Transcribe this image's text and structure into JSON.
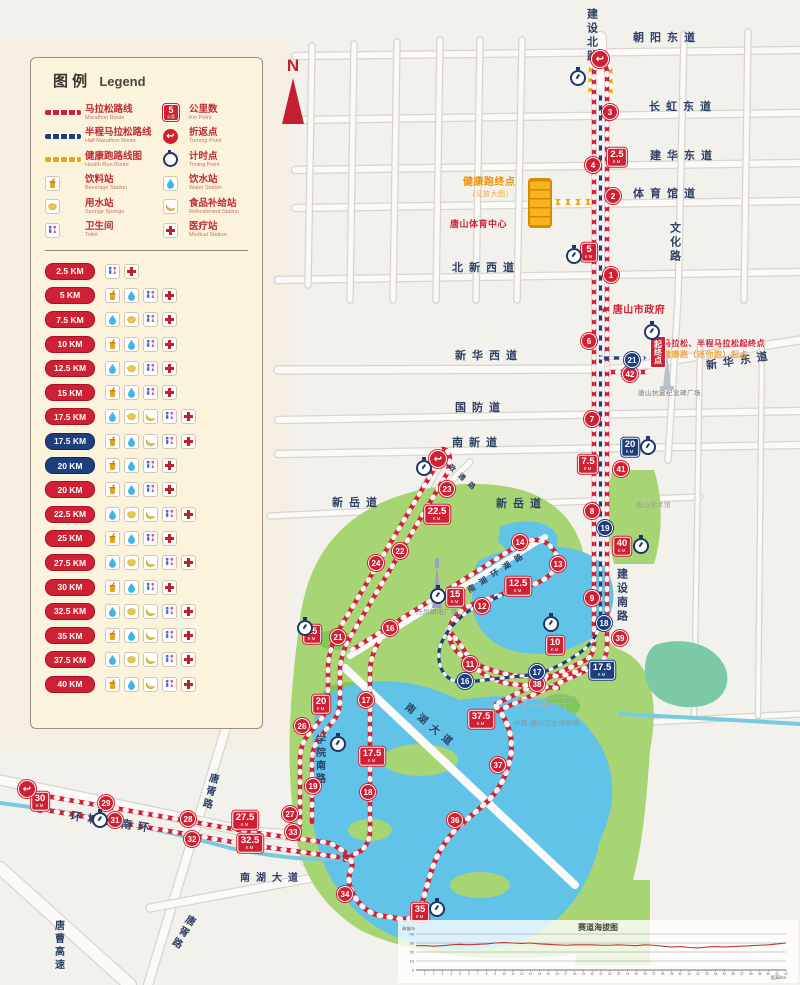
{
  "colors": {
    "marathon_red": "#cf2133",
    "half_blue": "#1d3f7e",
    "health_orange": "#f2a50c",
    "road_label": "#2e3f63"
  },
  "legend": {
    "title_zh": "图 例",
    "title_en": "Legend",
    "badge_sample": {
      "n": "5",
      "u": "公里"
    },
    "col1": [
      {
        "type": "line-red",
        "zh": "马拉松路线",
        "en": "Marathon Route"
      },
      {
        "type": "line-blue",
        "zh": "半程马拉松路线",
        "en": "Half Marathon Route"
      },
      {
        "type": "line-orange",
        "zh": "健康跑路线图",
        "en": "Health Run Route"
      },
      {
        "type": "beverage",
        "zh": "饮料站",
        "en": "Beverage Station"
      },
      {
        "type": "sponge",
        "zh": "用水站",
        "en": "Sponge Sponge"
      },
      {
        "type": "toilet",
        "zh": "卫生间",
        "en": "Toilet"
      }
    ],
    "col2": [
      {
        "type": "kmbadge",
        "zh": "公里数",
        "en": "Km Point"
      },
      {
        "type": "turn",
        "zh": "折返点",
        "en": "Turning Point"
      },
      {
        "type": "timer",
        "zh": "计时点",
        "en": "Timing Point"
      },
      {
        "type": "water",
        "zh": "饮水站",
        "en": "Water Station"
      },
      {
        "type": "food",
        "zh": "食品补给站",
        "en": "Refreshment Station"
      },
      {
        "type": "medical",
        "zh": "医疗站",
        "en": "Medical Station"
      }
    ],
    "km_rows": [
      {
        "km": "2.5 KM",
        "c": "red",
        "icons": [
          "toilet",
          "medical"
        ]
      },
      {
        "km": "5 KM",
        "c": "red",
        "icons": [
          "beverage",
          "water",
          "toilet",
          "medical"
        ]
      },
      {
        "km": "7.5 KM",
        "c": "red",
        "icons": [
          "water",
          "sponge",
          "toilet",
          "medical"
        ]
      },
      {
        "km": "10 KM",
        "c": "red",
        "icons": [
          "beverage",
          "water",
          "toilet",
          "medical"
        ]
      },
      {
        "km": "12.5 KM",
        "c": "red",
        "icons": [
          "water",
          "sponge",
          "toilet",
          "medical"
        ]
      },
      {
        "km": "15 KM",
        "c": "red",
        "icons": [
          "beverage",
          "water",
          "toilet",
          "medical"
        ]
      },
      {
        "km": "17.5 KM",
        "c": "red",
        "icons": [
          "water",
          "sponge",
          "food",
          "toilet",
          "medical"
        ]
      },
      {
        "km": "17.5 KM",
        "c": "blue",
        "icons": [
          "beverage",
          "water",
          "food",
          "toilet",
          "medical"
        ]
      },
      {
        "km": "20 KM",
        "c": "blue",
        "icons": [
          "beverage",
          "water",
          "toilet",
          "medical"
        ]
      },
      {
        "km": "20 KM",
        "c": "red",
        "icons": [
          "beverage",
          "water",
          "toilet",
          "medical"
        ]
      },
      {
        "km": "22.5 KM",
        "c": "red",
        "icons": [
          "water",
          "sponge",
          "food",
          "toilet",
          "medical"
        ]
      },
      {
        "km": "25 KM",
        "c": "red",
        "icons": [
          "beverage",
          "water",
          "toilet",
          "medical"
        ]
      },
      {
        "km": "27.5 KM",
        "c": "red",
        "icons": [
          "water",
          "sponge",
          "food",
          "toilet",
          "medical"
        ]
      },
      {
        "km": "30 KM",
        "c": "red",
        "icons": [
          "beverage",
          "water",
          "toilet",
          "medical"
        ]
      },
      {
        "km": "32.5 KM",
        "c": "red",
        "icons": [
          "water",
          "sponge",
          "food",
          "toilet",
          "medical"
        ]
      },
      {
        "km": "35 KM",
        "c": "red",
        "icons": [
          "beverage",
          "water",
          "food",
          "toilet",
          "medical"
        ]
      },
      {
        "km": "37.5 KM",
        "c": "red",
        "icons": [
          "water",
          "sponge",
          "food",
          "toilet",
          "medical"
        ]
      },
      {
        "km": "40 KM",
        "c": "red",
        "icons": [
          "beverage",
          "water",
          "food",
          "toilet",
          "medical"
        ]
      }
    ]
  },
  "map": {
    "north": "N",
    "unit": "KM",
    "roads": [
      {
        "t": "建设北路",
        "x": 585,
        "y": 8,
        "mode": "v",
        "size": 11
      },
      {
        "t": "朝阳东道",
        "x": 633,
        "y": 33,
        "mode": "h",
        "size": 11
      },
      {
        "t": "长虹东道",
        "x": 649,
        "y": 102,
        "mode": "h",
        "size": 11
      },
      {
        "t": "建华东道",
        "x": 650,
        "y": 151,
        "mode": "h",
        "size": 11
      },
      {
        "t": "体育馆道",
        "x": 633,
        "y": 189,
        "mode": "h",
        "size": 11
      },
      {
        "t": "文化路",
        "x": 668,
        "y": 222,
        "mode": "v",
        "size": 11
      },
      {
        "t": "北新西道",
        "x": 452,
        "y": 263,
        "mode": "h",
        "size": 11
      },
      {
        "t": "新华西道",
        "x": 455,
        "y": 351,
        "mode": "h",
        "size": 11
      },
      {
        "t": "新华东道",
        "x": 706,
        "y": 356,
        "mode": "h",
        "rot": -9,
        "size": 11
      },
      {
        "t": "国防道",
        "x": 455,
        "y": 403,
        "mode": "h",
        "size": 11
      },
      {
        "t": "南新道",
        "x": 452,
        "y": 438,
        "mode": "h",
        "size": 11
      },
      {
        "t": "新岳道",
        "x": 332,
        "y": 498,
        "mode": "h",
        "size": 11
      },
      {
        "t": "新岳道",
        "x": 496,
        "y": 499,
        "mode": "h",
        "size": 11
      },
      {
        "t": "政通路",
        "x": 444,
        "y": 476,
        "mode": "h",
        "rot": 42,
        "size": 7
      },
      {
        "t": "小南湖环湖路",
        "x": 450,
        "y": 572,
        "mode": "h",
        "rot": -33,
        "size": 8
      },
      {
        "t": "建设南路",
        "x": 615,
        "y": 568,
        "mode": "v",
        "size": 11
      },
      {
        "t": "南湖大道",
        "x": 398,
        "y": 722,
        "mode": "h",
        "rot": 40,
        "size": 10
      },
      {
        "t": "学院南路",
        "x": 313,
        "y": 734,
        "mode": "v",
        "size": 10
      },
      {
        "t": "唐胥路",
        "x": 203,
        "y": 772,
        "mode": "v",
        "rot": 14,
        "size": 10
      },
      {
        "t": "环城路南环",
        "x": 70,
        "y": 818,
        "mode": "h",
        "rot": 9,
        "size": 11
      },
      {
        "t": "南湖大道",
        "x": 240,
        "y": 874,
        "mode": "h",
        "size": 10
      },
      {
        "t": "唐胥路",
        "x": 176,
        "y": 912,
        "mode": "v",
        "rot": 30,
        "size": 10
      },
      {
        "t": "唐曹高速",
        "x": 52,
        "y": 920,
        "mode": "v",
        "size": 10
      }
    ],
    "landmarks": [
      {
        "t": "★ 唐山市政府",
        "x": 600,
        "y": 306,
        "color": "#cf2133",
        "size": 10,
        "bold": 1
      },
      {
        "t": "健康跑终点",
        "x": 463,
        "y": 178,
        "color": "#ef9200",
        "size": 10,
        "bold": 1
      },
      {
        "t": "（见放大图）",
        "x": 468,
        "y": 191,
        "color": "#f0a43c",
        "size": 7,
        "bold": 0
      },
      {
        "t": "唐山体育中心",
        "x": 450,
        "y": 220,
        "color": "#cf2133",
        "size": 9,
        "bold": 1
      },
      {
        "t": "马拉松、半程马拉松起终点",
        "x": 663,
        "y": 340,
        "color": "#cf2133",
        "size": 8,
        "bold": 1
      },
      {
        "t": "健康跑（迷你跑）起点",
        "x": 663,
        "y": 351,
        "color": "#f0a43c",
        "size": 8,
        "bold": 1
      },
      {
        "t": "唐山抗震纪念碑广场",
        "x": 638,
        "y": 391,
        "color": "#7a7a7a",
        "size": 6.5,
        "bold": 0
      },
      {
        "t": "唐山美术馆",
        "x": 636,
        "y": 503,
        "color": "#9a9a9a",
        "size": 6.5,
        "bold": 0
      },
      {
        "t": "丹凤朝阳广场",
        "x": 416,
        "y": 610,
        "color": "#8888a8",
        "size": 6.5,
        "bold": 0
      },
      {
        "t": "中国·唐山工业博物馆",
        "x": 514,
        "y": 721,
        "color": "#8a949c",
        "size": 6.5,
        "bold": 0
      }
    ],
    "start_banner": {
      "t": "起终点",
      "x": 650,
      "y": 336
    },
    "km_badges": [
      {
        "n": "2.5",
        "x": 617,
        "y": 157,
        "c": "red"
      },
      {
        "n": "5",
        "x": 589,
        "y": 252,
        "c": "red"
      },
      {
        "n": "7.5",
        "x": 588,
        "y": 464,
        "c": "red"
      },
      {
        "n": "10",
        "x": 555,
        "y": 645,
        "c": "red"
      },
      {
        "n": "12.5",
        "x": 518,
        "y": 586,
        "c": "red"
      },
      {
        "n": "15",
        "x": 455,
        "y": 597,
        "c": "red"
      },
      {
        "n": "17.5",
        "x": 372,
        "y": 756,
        "c": "red"
      },
      {
        "n": "17.5",
        "x": 602,
        "y": 670,
        "c": "blue"
      },
      {
        "n": "20",
        "x": 630,
        "y": 447,
        "c": "blue"
      },
      {
        "n": "20",
        "x": 321,
        "y": 704,
        "c": "red"
      },
      {
        "n": "22.5",
        "x": 437,
        "y": 514,
        "c": "red"
      },
      {
        "n": "25",
        "x": 312,
        "y": 634,
        "c": "red"
      },
      {
        "n": "27.5",
        "x": 245,
        "y": 820,
        "c": "red"
      },
      {
        "n": "30",
        "x": 40,
        "y": 801,
        "c": "red"
      },
      {
        "n": "32.5",
        "x": 250,
        "y": 843,
        "c": "red"
      },
      {
        "n": "35",
        "x": 420,
        "y": 912,
        "c": "red"
      },
      {
        "n": "37.5",
        "x": 481,
        "y": 719,
        "c": "red"
      },
      {
        "n": "40",
        "x": 622,
        "y": 546,
        "c": "red"
      }
    ],
    "km_circles": [
      {
        "n": "1",
        "x": 611,
        "y": 275,
        "c": "red"
      },
      {
        "n": "2",
        "x": 613,
        "y": 196,
        "c": "red"
      },
      {
        "n": "3",
        "x": 610,
        "y": 112,
        "c": "red"
      },
      {
        "n": "4",
        "x": 593,
        "y": 165,
        "c": "red"
      },
      {
        "n": "6",
        "x": 589,
        "y": 341,
        "c": "red"
      },
      {
        "n": "7",
        "x": 592,
        "y": 419,
        "c": "red"
      },
      {
        "n": "8",
        "x": 592,
        "y": 511,
        "c": "red"
      },
      {
        "n": "9",
        "x": 592,
        "y": 598,
        "c": "red"
      },
      {
        "n": "11",
        "x": 470,
        "y": 664,
        "c": "red"
      },
      {
        "n": "12",
        "x": 482,
        "y": 606,
        "c": "red"
      },
      {
        "n": "13",
        "x": 558,
        "y": 564,
        "c": "red"
      },
      {
        "n": "14",
        "x": 520,
        "y": 542,
        "c": "red"
      },
      {
        "n": "16",
        "x": 390,
        "y": 628,
        "c": "red"
      },
      {
        "n": "17",
        "x": 366,
        "y": 700,
        "c": "red"
      },
      {
        "n": "18",
        "x": 368,
        "y": 792,
        "c": "red"
      },
      {
        "n": "19",
        "x": 313,
        "y": 786,
        "c": "red"
      },
      {
        "n": "21",
        "x": 338,
        "y": 637,
        "c": "red"
      },
      {
        "n": "22",
        "x": 400,
        "y": 551,
        "c": "red"
      },
      {
        "n": "23",
        "x": 447,
        "y": 489,
        "c": "red"
      },
      {
        "n": "24",
        "x": 376,
        "y": 563,
        "c": "red"
      },
      {
        "n": "26",
        "x": 302,
        "y": 726,
        "c": "red"
      },
      {
        "n": "27",
        "x": 290,
        "y": 814,
        "c": "red"
      },
      {
        "n": "28",
        "x": 188,
        "y": 819,
        "c": "red"
      },
      {
        "n": "29",
        "x": 106,
        "y": 803,
        "c": "red"
      },
      {
        "n": "31",
        "x": 115,
        "y": 820,
        "c": "red"
      },
      {
        "n": "32",
        "x": 192,
        "y": 839,
        "c": "red"
      },
      {
        "n": "33",
        "x": 293,
        "y": 832,
        "c": "red"
      },
      {
        "n": "34",
        "x": 345,
        "y": 894,
        "c": "red"
      },
      {
        "n": "36",
        "x": 455,
        "y": 820,
        "c": "red"
      },
      {
        "n": "37",
        "x": 498,
        "y": 765,
        "c": "red"
      },
      {
        "n": "38",
        "x": 537,
        "y": 684,
        "c": "red"
      },
      {
        "n": "39",
        "x": 620,
        "y": 638,
        "c": "red"
      },
      {
        "n": "41",
        "x": 621,
        "y": 469,
        "c": "red"
      },
      {
        "n": "42",
        "x": 630,
        "y": 374,
        "c": "red"
      },
      {
        "n": "16",
        "x": 465,
        "y": 681,
        "c": "blue"
      },
      {
        "n": "17",
        "x": 537,
        "y": 672,
        "c": "blue"
      },
      {
        "n": "18",
        "x": 604,
        "y": 623,
        "c": "blue"
      },
      {
        "n": "19",
        "x": 605,
        "y": 528,
        "c": "blue"
      },
      {
        "n": "21",
        "x": 632,
        "y": 360,
        "c": "blue"
      }
    ],
    "turn_points": [
      [
        600,
        59
      ],
      [
        438,
        459
      ],
      [
        27,
        789
      ]
    ],
    "timing_points": [
      [
        578,
        78
      ],
      [
        574,
        256
      ],
      [
        652,
        332
      ],
      [
        648,
        447
      ],
      [
        641,
        546
      ],
      [
        551,
        624
      ],
      [
        438,
        596
      ],
      [
        424,
        468
      ],
      [
        305,
        628
      ],
      [
        338,
        744
      ],
      [
        100,
        820
      ],
      [
        437,
        909
      ]
    ]
  },
  "chart_data": {
    "type": "line",
    "title": "赛道海拔图",
    "ylabel": "海拔/m",
    "xlabel": "距离/km",
    "ylim": [
      0,
      40
    ],
    "yticks": [
      0,
      10,
      20,
      30,
      40
    ],
    "x": [
      0,
      1,
      2,
      3,
      4,
      5,
      6,
      7,
      8,
      9,
      10,
      11,
      12,
      13,
      14,
      15,
      16,
      17,
      18,
      19,
      20,
      21,
      22,
      23,
      24,
      25,
      26,
      27,
      28,
      29,
      30,
      31,
      32,
      33,
      34,
      35,
      36,
      37,
      38,
      39,
      40,
      41,
      42
    ],
    "values": [
      27,
      27,
      26.5,
      27,
      28,
      28.5,
      28,
      28.5,
      29,
      30,
      30.5,
      30,
      29.5,
      30,
      29,
      28.5,
      28,
      27.5,
      28,
      28,
      28,
      27.5,
      27.5,
      28,
      27.5,
      27,
      28,
      27.5,
      26.5,
      25.5,
      26,
      25,
      24.5,
      25.5,
      26,
      25.5,
      26,
      26.5,
      27,
      27.5,
      28,
      29,
      30
    ],
    "line_color": "#c0392b"
  }
}
